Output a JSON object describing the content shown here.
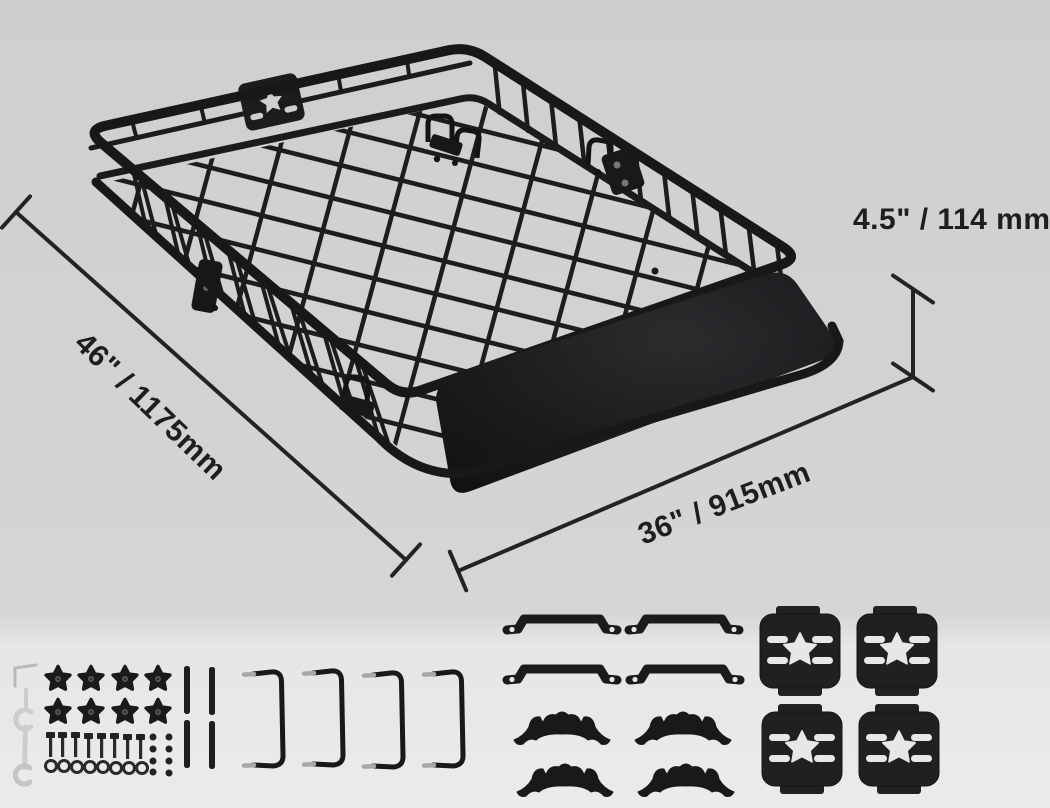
{
  "scene": {
    "type": "product dimension diagram",
    "subject": "roof rack cargo basket with wind fairing and mounting hardware kit",
    "colors": {
      "background_top": "#d0d0d2",
      "background_bottom": "#ebebec",
      "product_black": "#1a1a1c",
      "dimension_line": "#232323",
      "text": "#1e1e1e",
      "metal_light": "#c9c9cd"
    }
  },
  "dimension_labels": {
    "height": "4.5\" / 114 mm",
    "length": "46\" / 1175mm",
    "width": "36\" / 915mm"
  },
  "product_features": {
    "star_logo_plate_on_basket": 1,
    "wind_fairing_panel": 1,
    "mounting_clamp_sets_visible": 3
  },
  "hardware_kit": {
    "wrench": 1,
    "hex_key": 1,
    "star_knobs": 8,
    "bolts": 8,
    "nuts": 8,
    "washers": 8,
    "extension_rods": 4,
    "u_bolt_brackets": 4,
    "strap_clamps": 4,
    "serrated_saddle_pads": 4,
    "star_mounting_plates": 4
  }
}
